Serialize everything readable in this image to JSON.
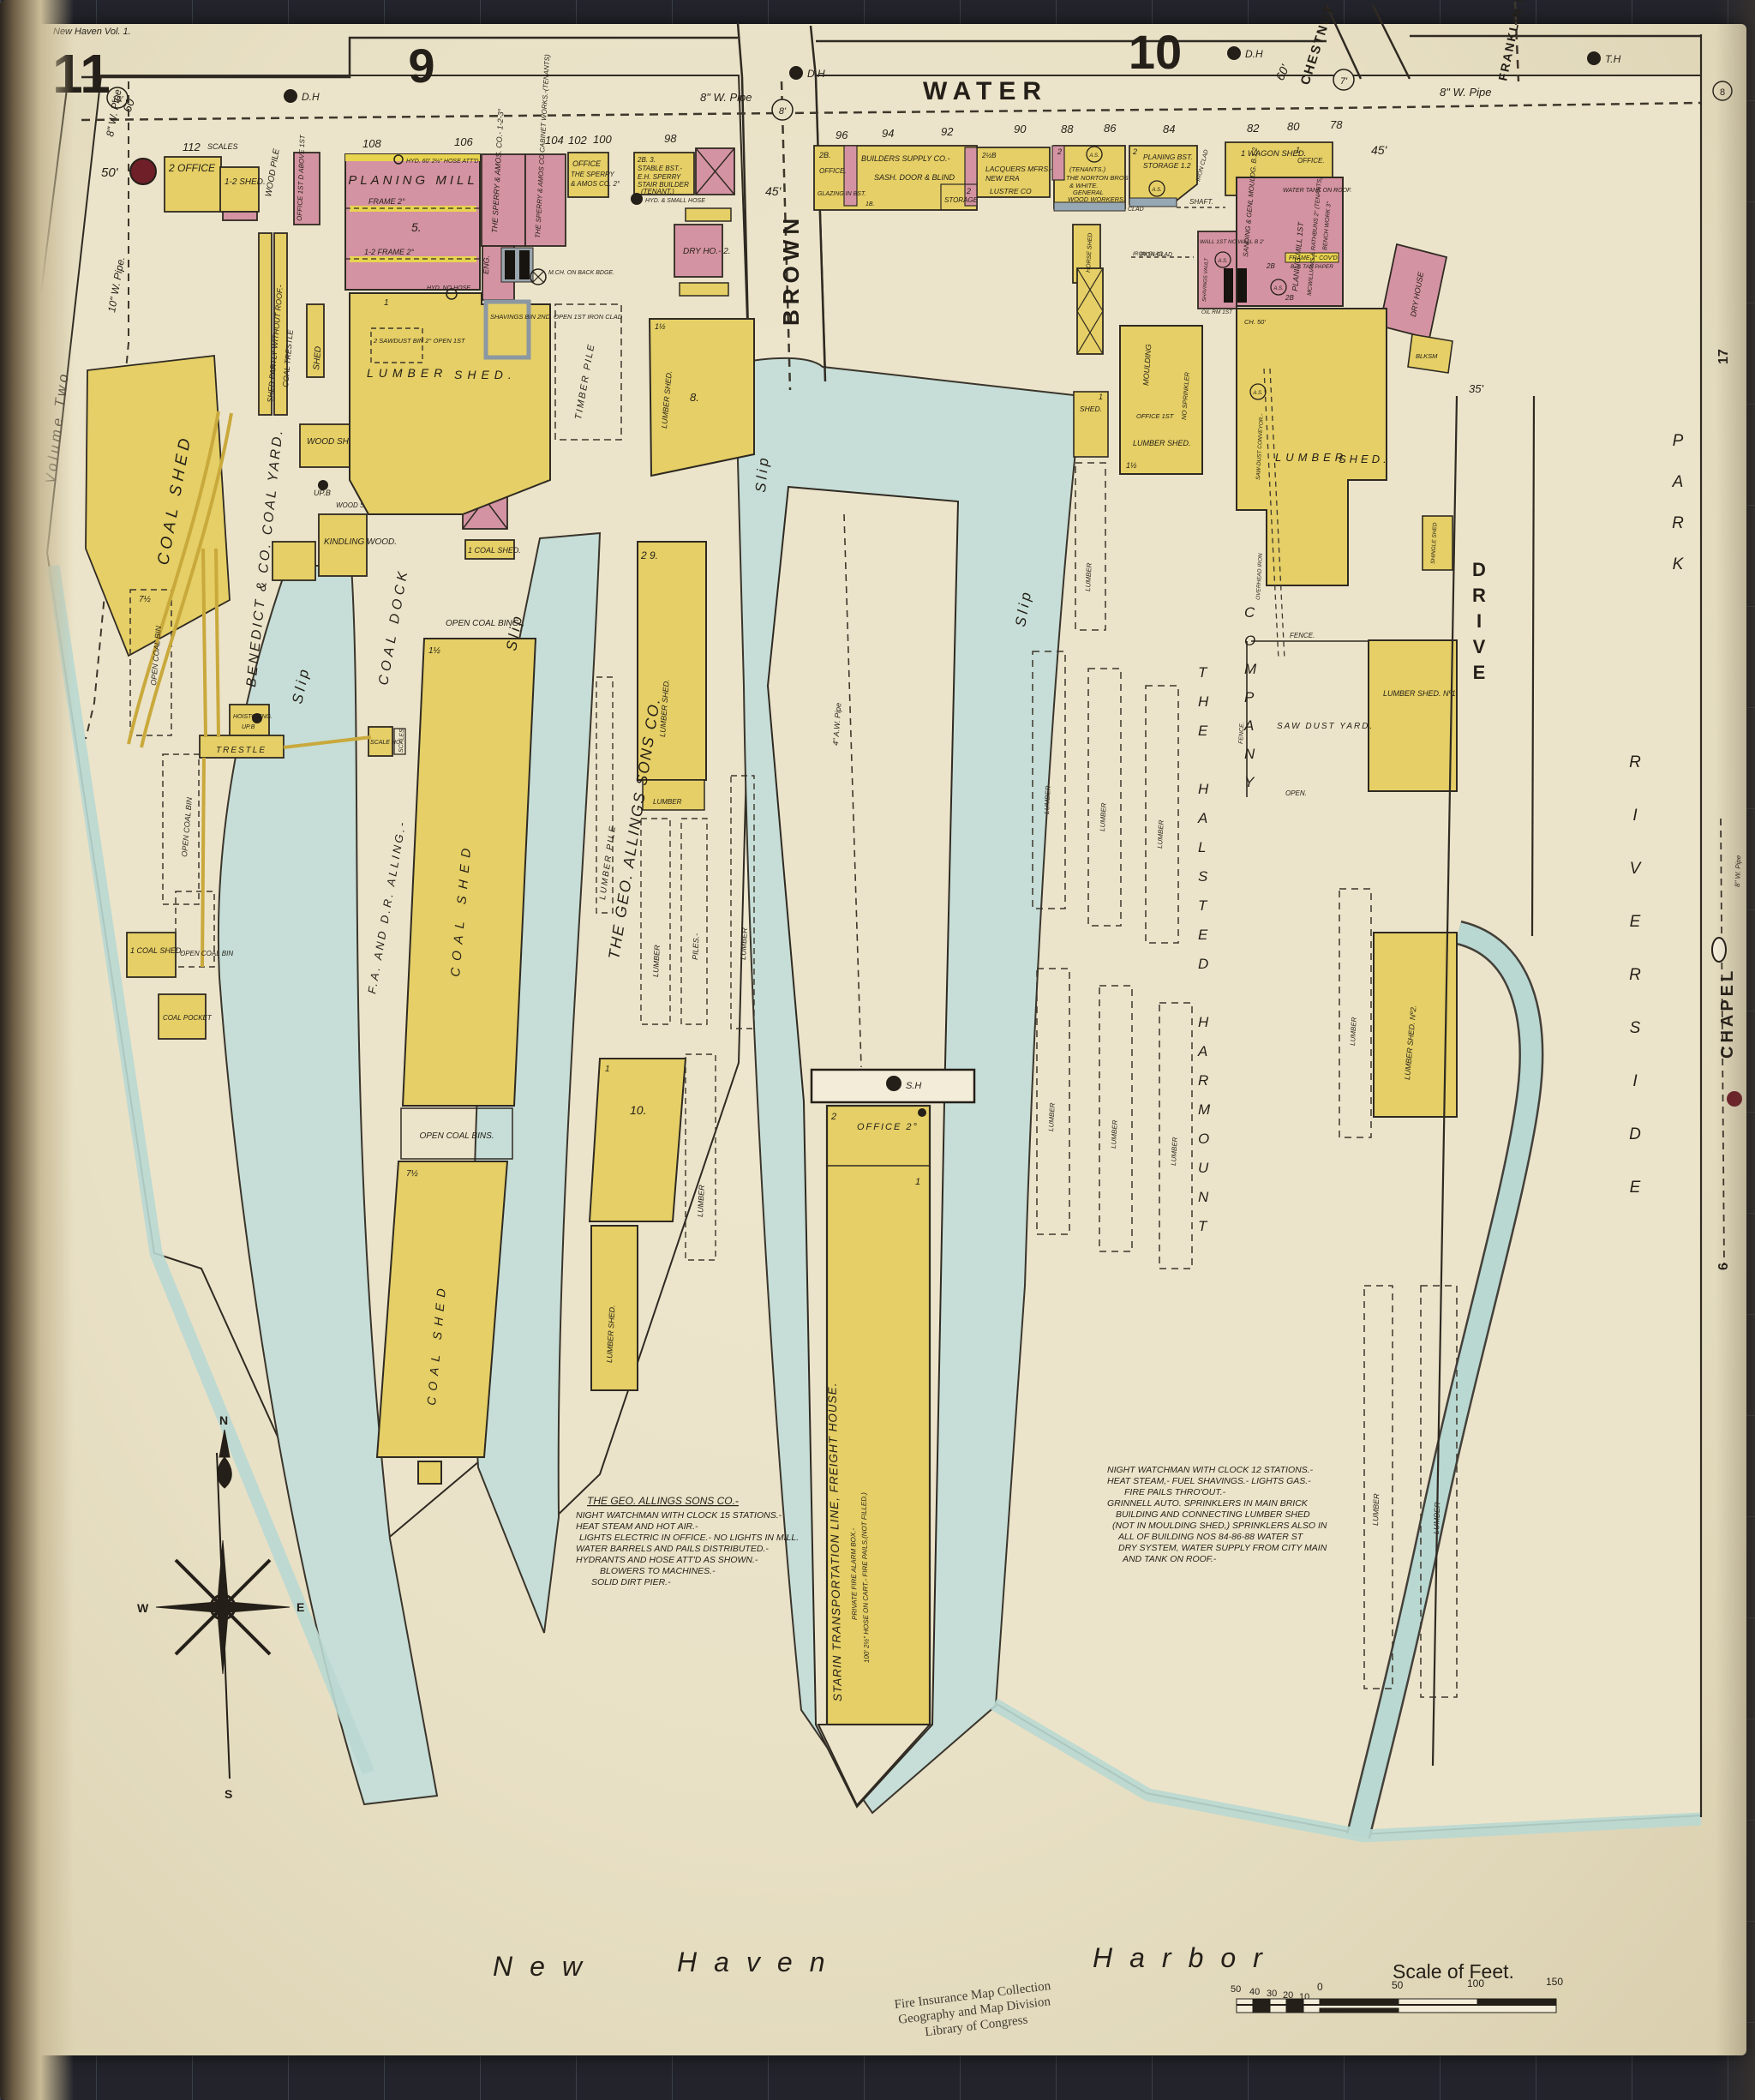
{
  "meta": {
    "volume_ref": "New Haven Vol. 1.",
    "sheet": "11",
    "edge_top": "17",
    "edge_mid": "6",
    "edge_circle": "8"
  },
  "sections": {
    "left": "9",
    "right": "10"
  },
  "streets": {
    "water": "WATER",
    "brown": "BROWN",
    "chestnut": "CHESTNUT ST.",
    "franklin": "FRANKLIN ST.",
    "chapel": "CHAPEL",
    "drive": "DRIVE",
    "brewery": "BREWERY",
    "riverside": "RIVERSIDE",
    "park": "PARK",
    "see": "See",
    "volume_two": "Volume Two"
  },
  "harbor": {
    "w1": "New",
    "w2": "Haven",
    "w3": "Harbor"
  },
  "house_numbers": [
    "112",
    "108",
    "106",
    "104",
    "102",
    "100",
    "98",
    "96",
    "94",
    "92",
    "90",
    "88",
    "86",
    "84",
    "82",
    "80",
    "78"
  ],
  "ann": {
    "dh": "D.H",
    "th": "T.H",
    "sh": "S.H",
    "upb": "UP.B",
    "pipe8": "8\" W. Pipe",
    "pipe10": "10\" W. Pipe.",
    "pipe4": "4\" A.W. Pipe",
    "pipe8c": "8\" W. Pipe",
    "c10": "10'",
    "c8": "8'",
    "c7": "7'",
    "n60a": "60",
    "n60b": "60'",
    "w45a": "45'",
    "w45b": "45'",
    "w50": "50'",
    "w35": "35'"
  },
  "g": {
    "lumber": "LUMBER",
    "slip": "Slip",
    "shed": "SHED.",
    "coal_shed": "COAL SHED",
    "lumber_shed": "LUMBER SHED.",
    "office": "OFFICE.",
    "fence": "FENCE.",
    "open": "OPEN.",
    "as": "A.S.",
    "scales": "SCALES",
    "trestle": "TRESTLE",
    "open_coal_bin": "OPEN COAL BIN",
    "piles": "PILES.-",
    "one": "1",
    "two": "2",
    "n8": "8.",
    "n5": "5.",
    "n10": "10.",
    "n1h": "1½",
    "n7h": "7½",
    "n29": "2  9.",
    "iron_clad": "IRON CLAD",
    "clad": "CLAD"
  },
  "benedict": {
    "office": "2 OFFICE",
    "shed12": "1-2 SHED.",
    "wood_pile": "WOOD PILE",
    "office_d": "OFFICE 1ST D ABOVE 1ST",
    "yard": "BENEDICT & CO. COAL YARD.",
    "partly": "SHED PARTLY WITHOUT ROOF.-",
    "coal_trestle": "COAL TRESTLE",
    "shed_v": "SHED",
    "wood_shed": "WOOD SHED.",
    "wood_saw": "WOOD SAW 1-1½",
    "kindling": "KINDLING WOOD.",
    "hoistg": "HOISTG ENG.",
    "scale_ho": "SCALE HO.",
    "open_bins": "OPEN COAL BINS.",
    "open_bing": "OPEN COAL BING.",
    "coal_pocket": "COAL POCKET",
    "coal_shed_1": "1 COAL SHED.",
    "shed_1": "1 SHED."
  },
  "allings": {
    "planing_mill": "PLANING MILL",
    "frame2": "FRAME 2°",
    "frame2b": "1-2 FRAME 2°",
    "sperry1": "THE SPERRY & AMOS. CO.- 1-2-3°",
    "sperry2": "THE SPERRY & AMOS CO CABINET WORKS.-(TENANTS)",
    "eng": "ENG.",
    "mch": "M.CH. ON BACK BDGE.",
    "office_l1": "OFFICE",
    "office_l2": "THE SPERRY",
    "office_l3": "& AMOS CO. 2°",
    "stable_l1": "2B.  3.",
    "stable_l2": "STABLE BST.-",
    "stable_l3": "E.H. SPERRY",
    "stable_l4": "STAIR BUILDER",
    "stable_l5": "(TENANT.)",
    "dry_ho": "DRY HO.- 2.",
    "shavings": "SHAVINGS BIN 2ND. OPEN 1ST IRON CLAD",
    "sawdust": "2 SAWDUST BIN 2° OPEN 1ST",
    "hyd60": "HYD. 60' 2½\" HOSE ATT'D",
    "hyd_small": "HYD. & SMALL HOSE",
    "hyd_no": "HYD. NO HOSE",
    "timber_pile": "TIMBER PILE",
    "lumber_pile": "LUMBER PILE",
    "company": "THE GEO. ALLINGS SONS CO."
  },
  "alling_dock": {
    "fa": "F.A. AND D.R. ALLING.-",
    "coal_dock": "COAL DOCK"
  },
  "starin": {
    "office": "OFFICE 2°",
    "main": "STARIN TRANSPORTATION LINE, FREIGHT HOUSE.",
    "sub1": "PRIVATE FIRE ALARM BOX.-",
    "sub2": "100' 2½\" HOSE ON CART.- FIRE PAILS,(NOT FILLED.)"
  },
  "frontage": {
    "b2b": "2B.",
    "builders": "BUILDERS SUPPLY CO.-",
    "glazing": "GLAZING IN BST.",
    "sash": "SASH. DOOR & BLIND",
    "storage": "STORAGE",
    "b1b": "1B.",
    "n2hb": "2½B",
    "lacquers": "LACQUERS MFRS.-",
    "new_era": "NEW ERA",
    "lustre": "LUSTRE CO",
    "tenants": "(TENANTS.)",
    "norton": "THE NORTON BROS",
    "white": "& WHITE.",
    "general": "GENERAL",
    "woodworkers": "WOOD WORKERS.",
    "planing_bst": "PLANING BST.",
    "storage12": "STORAGE 1.2",
    "wagon": "1 WAGON SHED.",
    "shaft": "SHAFT.",
    "horse": "HORSE SHED"
  },
  "halsted": {
    "sanding": "SANDING & GENL MOULDG. B.1.2",
    "tank": "WATER TANK ON ROOF.",
    "planing1": "PLANING MILL 1ST",
    "mcw": "MCWILLIAMS & RATHBUNS 2° (TENANTS)",
    "bench": "BENCH WORK 3°",
    "frame3": "FRAME 3° COV'D",
    "tar": "B. & TAR PAPER",
    "wall": "WALL 1ST NO WALL B 2'",
    "vault": "SHAVINGS VAULT",
    "oil": "OIL RM 1ST",
    "ch50": "CH. 50'",
    "b2": "2B",
    "dry_house": "DRY HOUSE",
    "blksm": "BLKSM",
    "shingle": "SHINGLE SHED",
    "moulding": "MOULDING",
    "no_sprink": "NO SPRINKLER",
    "office1": "OFFICE 1ST",
    "conveyor": "SAW-DUST CONVEYOR.-",
    "overhead": "OVERHEAD IRON",
    "sawdust_yard": "SAW DUST YARD.",
    "shed_no1": "LUMBER SHED. Nº1.",
    "shed_no2": "LUMBER SHED. Nº2.",
    "name1": "THE HALSTED HARMOUNT",
    "name2": "COMPANY"
  },
  "notes": {
    "allings_title": "THE GEO. ALLINGS SONS CO.-",
    "allings": [
      "NIGHT WATCHMAN WITH CLOCK 15 STATIONS.-",
      "HEAT STEAM AND HOT AIR.-",
      "LIGHTS ELECTRIC IN OFFICE.- NO LIGHTS IN MILL.",
      "WATER BARRELS AND PAILS DISTRIBUTED.-",
      "HYDRANTS AND HOSE ATT'D AS SHOWN.-",
      "BLOWERS TO MACHINES.-",
      "SOLID DIRT PIER.-"
    ],
    "halsted": [
      "NIGHT WATCHMAN WITH CLOCK 12 STATIONS.-",
      "HEAT STEAM,- FUEL SHAVINGS.- LIGHTS GAS.-",
      "FIRE PAILS THRO'OUT.-",
      "GRINNELL AUTO. SPRINKLERS IN MAIN BRICK",
      "BUILDING AND CONNECTING LUMBER SHED",
      "(NOT IN MOULDING SHED,) SPRINKLERS ALSO IN",
      "ALL OF BUILDING NOS 84-86-88 WATER ST",
      "DRY SYSTEM, WATER SUPPLY FROM CITY MAIN",
      "AND TANK ON ROOF.-"
    ]
  },
  "scale_bar": {
    "title": "Scale of Feet.",
    "ticks": [
      "50",
      "40",
      "30",
      "20",
      "10",
      "0",
      "50",
      "100",
      "150"
    ]
  },
  "stamp": [
    "Fire Insurance Map Collection",
    "Geography and Map Division",
    "Library of Congress"
  ],
  "compass": {
    "n": "N",
    "e": "E",
    "w": "W",
    "s": "S"
  },
  "colors": {
    "paper": "#e9e1c6",
    "frame_yellow": "#e5cf66",
    "brick_pink": "#d493a2",
    "water": "#c6ded7",
    "dark_red": "#6e1f28",
    "stamp_red": "#b5524a"
  }
}
